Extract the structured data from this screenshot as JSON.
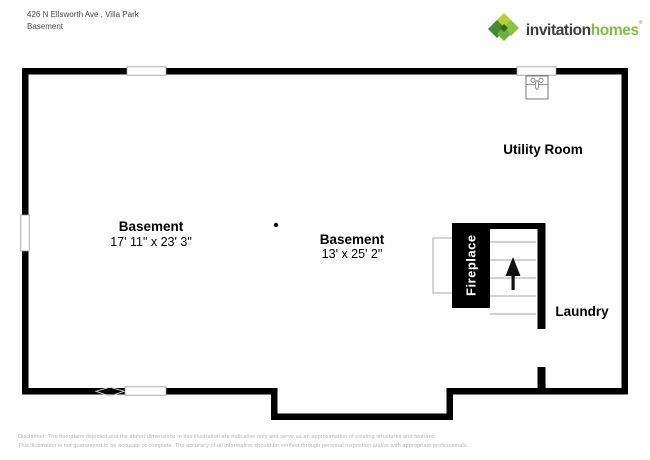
{
  "header": {
    "address": "426 N Ellsworth Ave , Villa Park",
    "floor": "Basement",
    "logo": {
      "word1": "invitation",
      "word2": "homes",
      "mark": "®",
      "brand_green": "#84bd41",
      "brand_dark_text": "#3d3d3d",
      "icon_name": "invitation-homes-pinwheel-logo",
      "icon_colors": [
        "#b5d334",
        "#8bc53f",
        "#47892c",
        "#6fb043",
        "#2f6b25"
      ]
    }
  },
  "floorplan": {
    "wall_color": "#000000",
    "stair_tread_color": "#b8b8b8",
    "utility": {
      "name": "Utility Room"
    },
    "basement1": {
      "name": "Basement",
      "dims": "17' 11\" x 23' 3\""
    },
    "basement2": {
      "name": "Basement",
      "dims": "13' x 25' 2\""
    },
    "laundry": {
      "name": "Laundry"
    },
    "fireplace": {
      "label": "Fireplace"
    },
    "icons": {
      "sink": "utility-sink-icon",
      "stairs_arrow": "stairs-up-arrow-icon",
      "column": "support-column-dot",
      "door_marker": "door-marker-diamond",
      "windows": "window-opening x4"
    }
  },
  "footer": {
    "line1": "Disclaimer: The floorplans depicted and the stated dimensions in this illustration are indicative only and serve as an approximation of existing structures and features.",
    "line2": "This illustration is not guaranteed to be accurate or complete. The accuracy of all information should be verified through personal inspection and/or with appropriate professionals."
  }
}
